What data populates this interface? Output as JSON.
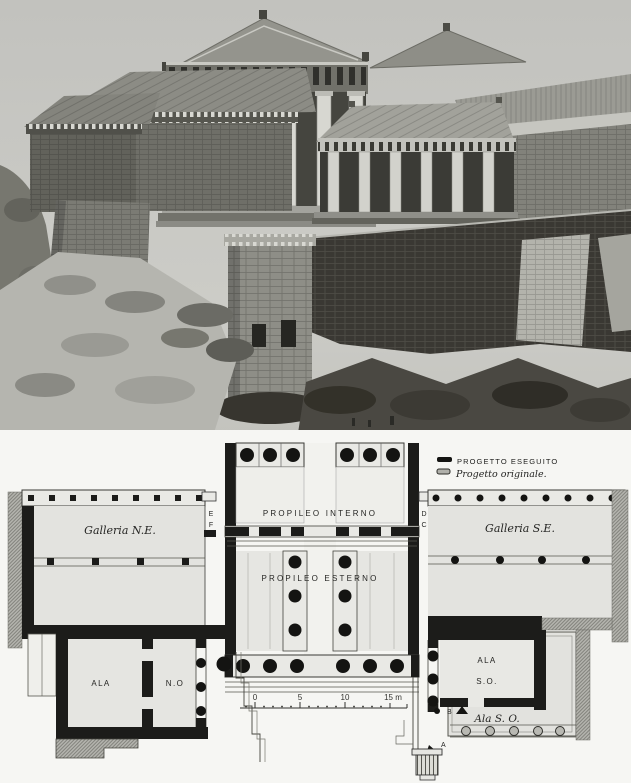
{
  "colors": {
    "sky": "#c6c6c2",
    "plan_paper": "#e4e4e0",
    "wall_ink": "#1c1c1a",
    "hatch_gray": "#b0b0aa",
    "page": "#f6f6f3"
  },
  "legend": {
    "executed_label": "PROGETTO ESEGUITO",
    "original_label": "Progetto originale."
  },
  "plan": {
    "propileo_interno": "PROPILEO INTERNO",
    "propileo_esterno": "PROPILEO ESTERNO",
    "galleria_ne": "Galleria N.E.",
    "galleria_se": "Galleria S.E.",
    "ala_no_room": "ALA",
    "ala_no_vestibule": "N.O",
    "ala_so_line1": "ALA",
    "ala_so_line2": "S.O.",
    "ala_so_original": "Ala S. O.",
    "markers": {
      "e": "E",
      "f": "F",
      "d": "D",
      "c": "C",
      "b": "B",
      "a": "A"
    }
  },
  "scale_bar": {
    "t0": "0",
    "t5": "5",
    "t10": "10",
    "t15": "15 m"
  }
}
